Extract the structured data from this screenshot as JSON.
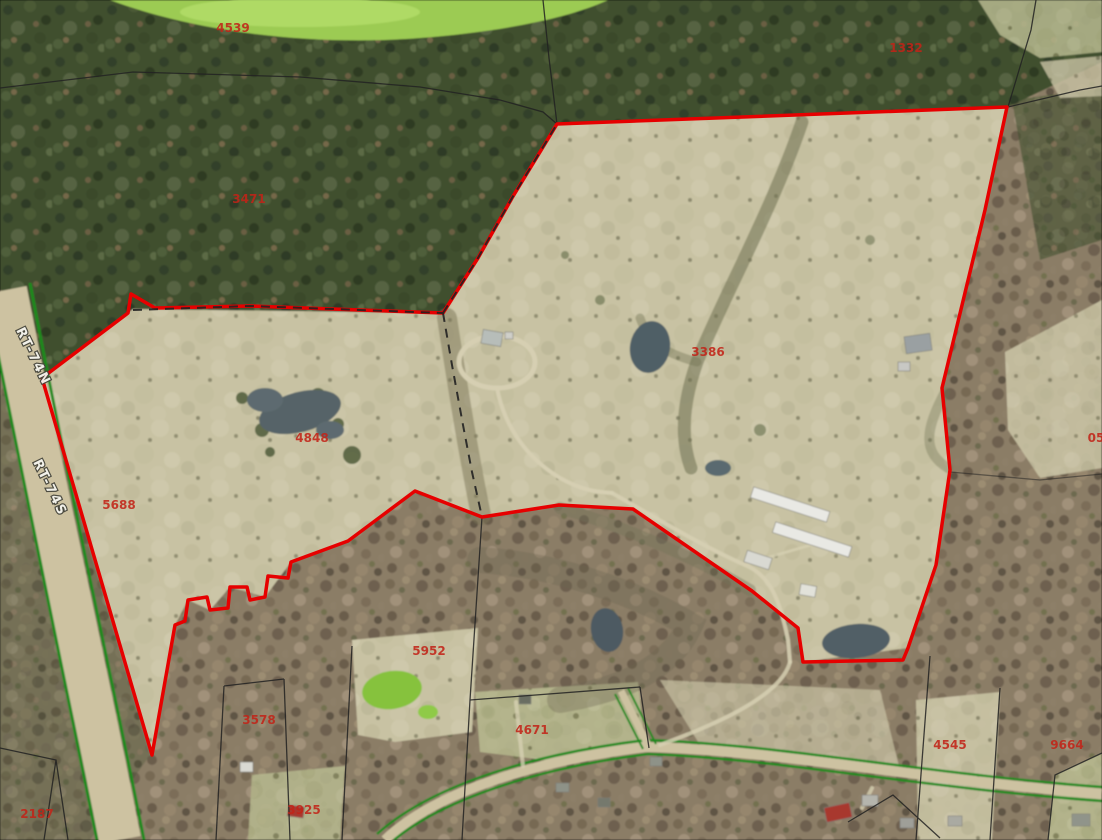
{
  "map": {
    "kind": "aerial-parcel-map",
    "colors": {
      "boundary_red": "#e60000",
      "parcel_line_black": "#222222",
      "parcel_label_red": "#c22418",
      "road_edge_green": "#1e8a1e",
      "road_surface_tan": "#cdc2a1",
      "road_label_white": "#f4f4ee"
    },
    "parcel_labels": [
      {
        "text": "4539",
        "x": 233,
        "y": 32
      },
      {
        "text": "3471",
        "x": 249,
        "y": 203
      },
      {
        "text": "1332",
        "x": 906,
        "y": 52
      },
      {
        "text": "3386",
        "x": 708,
        "y": 356
      },
      {
        "text": "4848",
        "x": 312,
        "y": 442
      },
      {
        "text": "5688",
        "x": 119,
        "y": 509
      },
      {
        "text": "05",
        "x": 1096,
        "y": 442
      },
      {
        "text": "5952",
        "x": 429,
        "y": 655
      },
      {
        "text": "3578",
        "x": 259,
        "y": 724
      },
      {
        "text": "4671",
        "x": 532,
        "y": 734
      },
      {
        "text": "4545",
        "x": 950,
        "y": 749
      },
      {
        "text": "9664",
        "x": 1067,
        "y": 749
      },
      {
        "text": "2187",
        "x": 37,
        "y": 818
      },
      {
        "text": "3925",
        "x": 304,
        "y": 814
      }
    ],
    "road_labels": [
      {
        "text": "RT-74N",
        "x": 16,
        "y": 330,
        "angle": 64
      },
      {
        "text": "RT-74S",
        "x": 33,
        "y": 462,
        "angle": 64
      }
    ]
  }
}
